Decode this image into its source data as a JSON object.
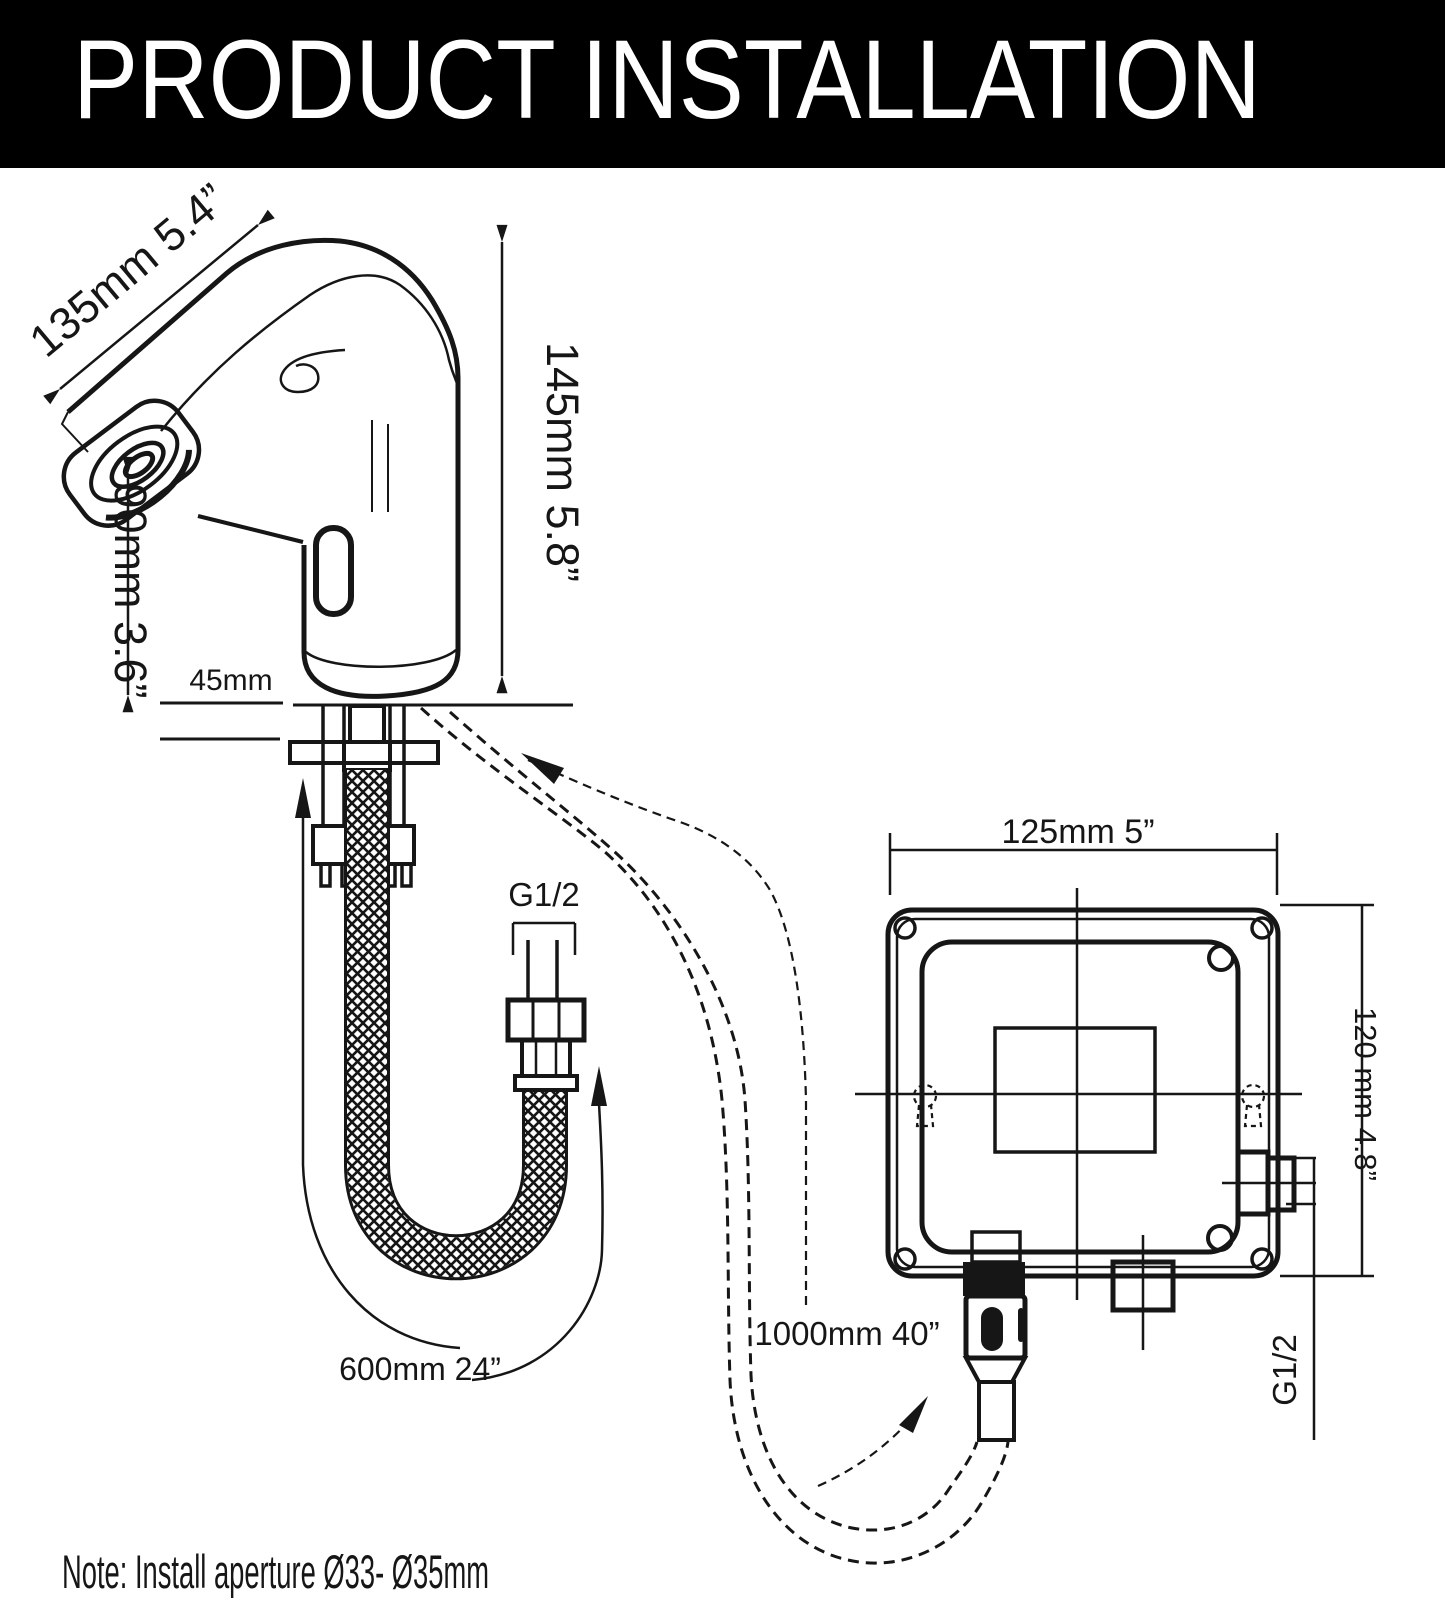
{
  "header": {
    "title": "PRODUCT INSTALLATION"
  },
  "diagram": {
    "faucet": {
      "spout_reach": "135mm 5.4”",
      "height": "145mm 5.8”",
      "spout_height": "90mm 3.6”",
      "deck_label": "45mm"
    },
    "supply_hose": {
      "thread": "G1/2",
      "length": "600mm 24”"
    },
    "sensor_cable": {
      "length": "1000mm 40”"
    },
    "control_box": {
      "width": "125mm 5”",
      "height": "120 mm 4.8”",
      "outlet_thread": "G1/2"
    }
  },
  "note": "Note: Install aperture Ø33- Ø35mm",
  "colors": {
    "ink": "#161616",
    "header_bg": "#000000",
    "header_text": "#ffffff",
    "paper": "#ffffff"
  }
}
